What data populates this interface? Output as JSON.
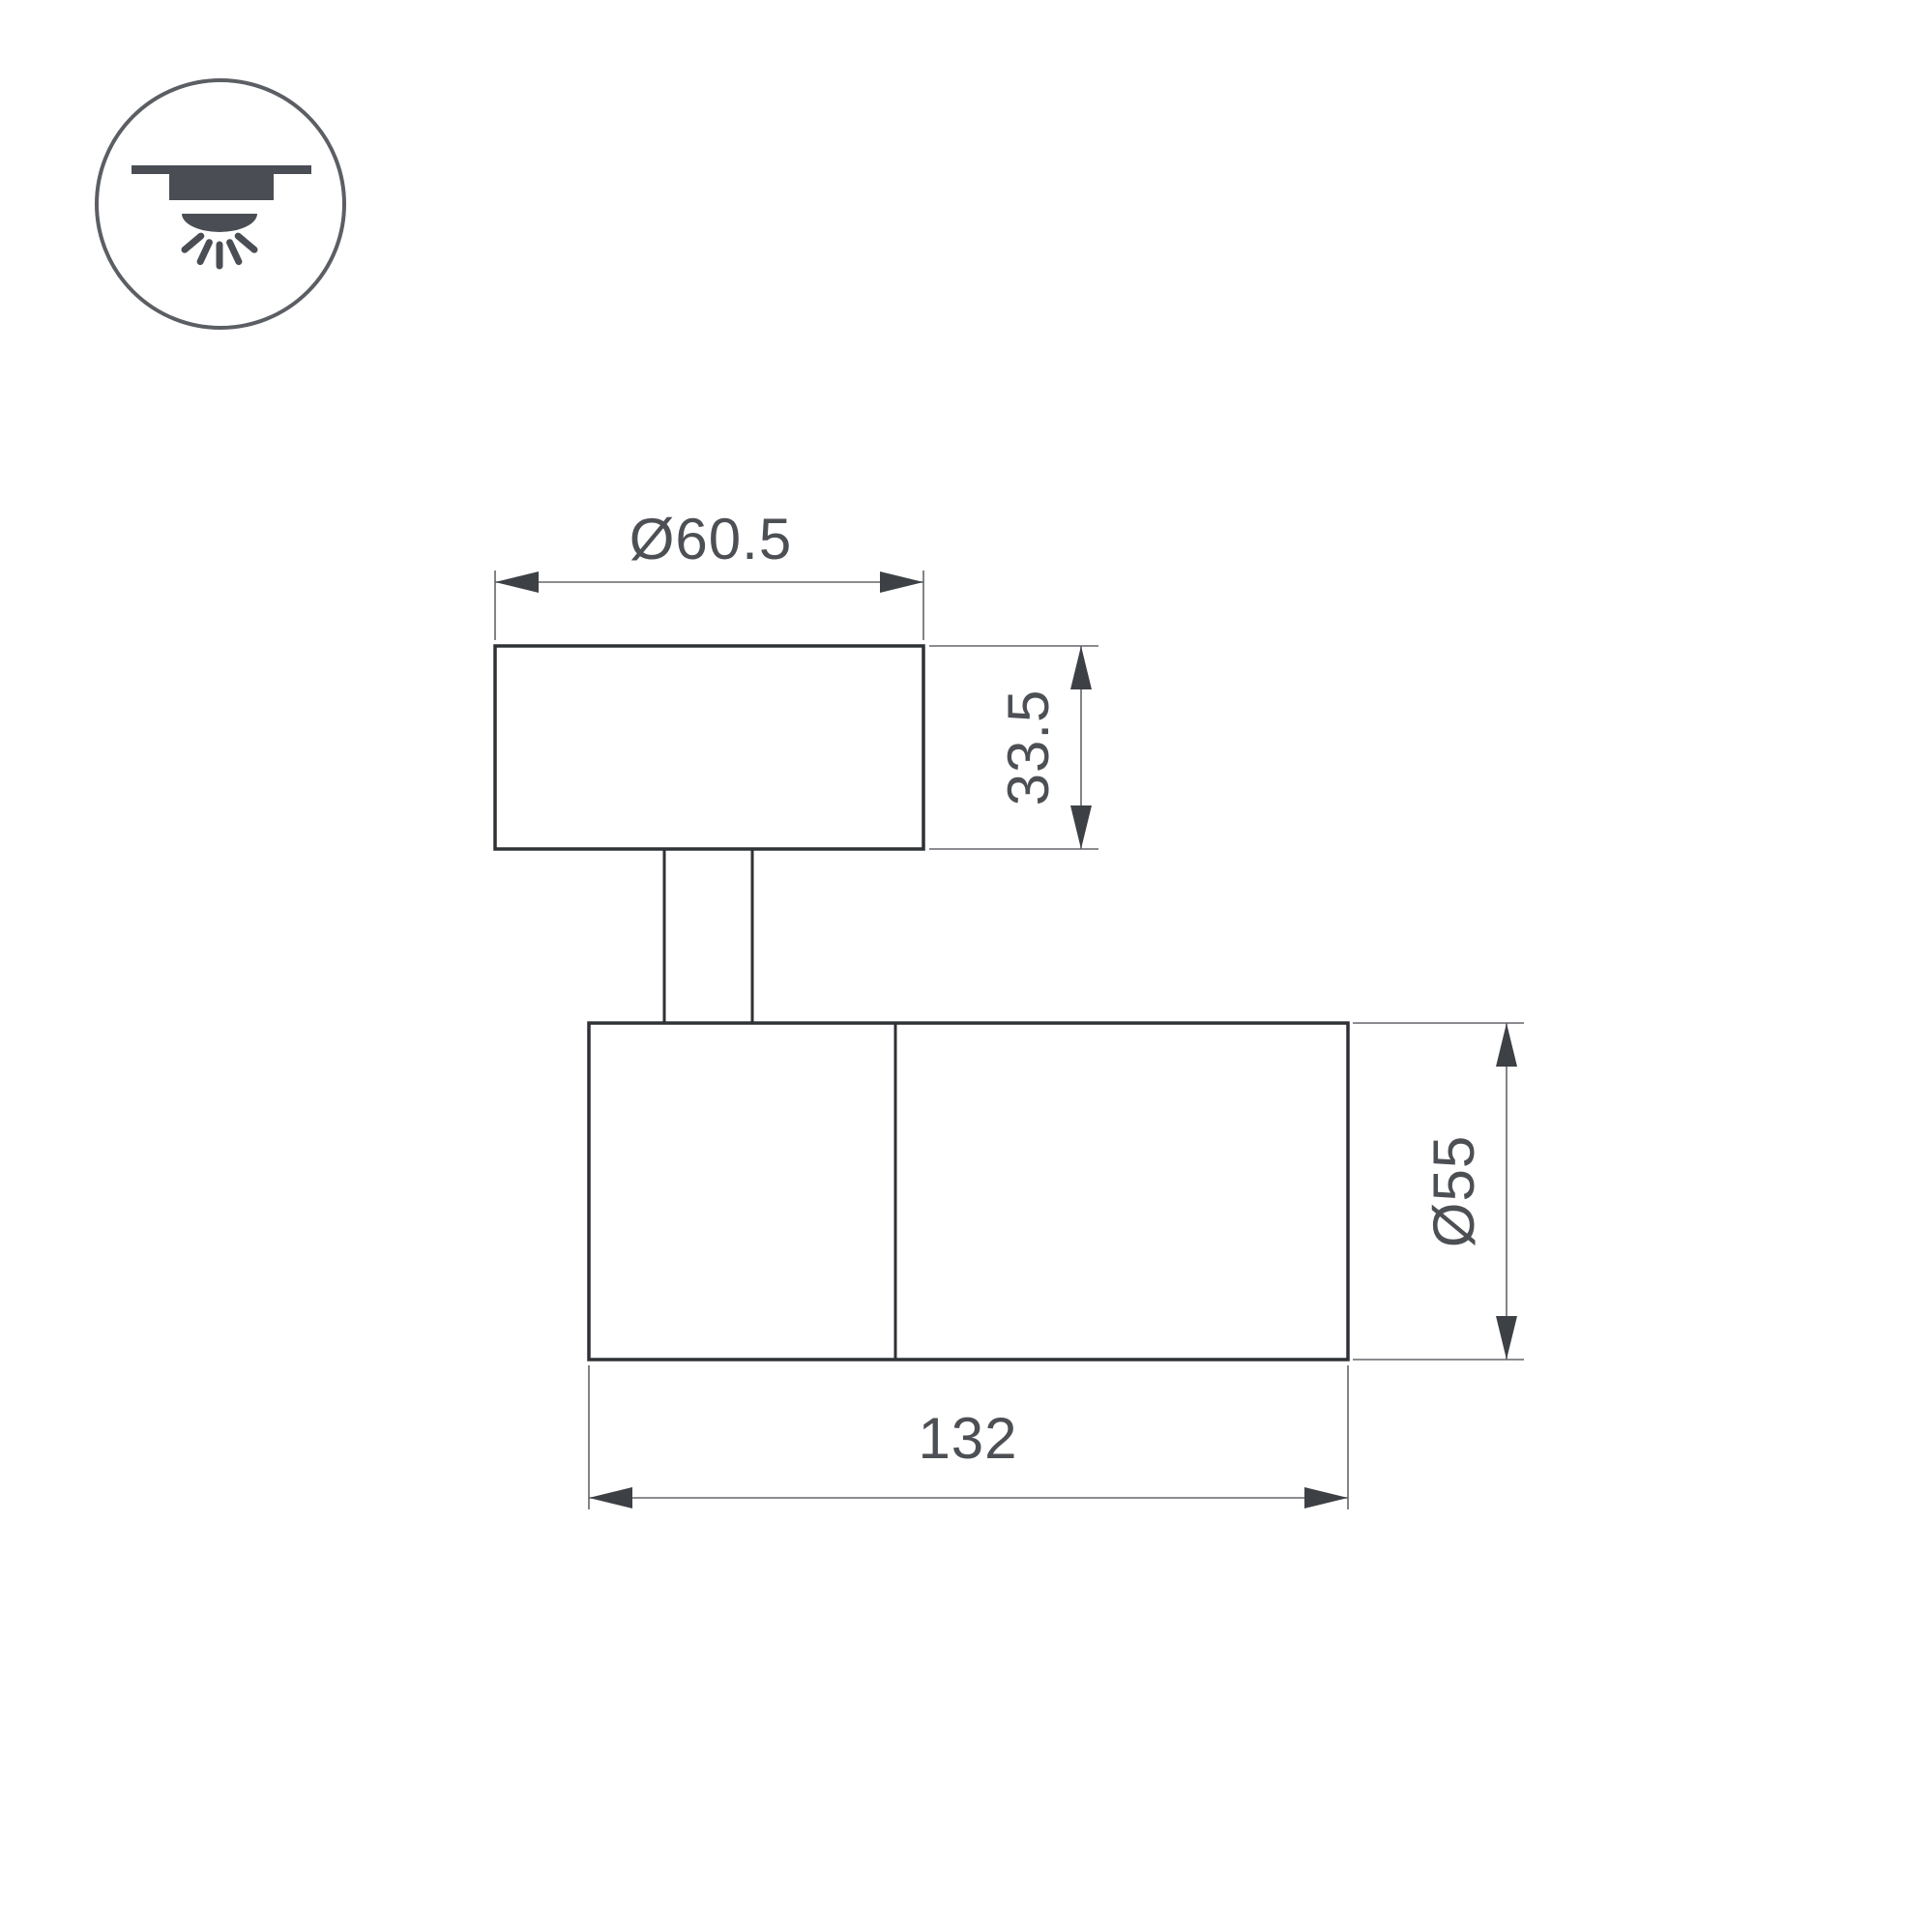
{
  "page": {
    "background_color": "#ffffff"
  },
  "mount_type_icon": {
    "meaning": "surface-mounted-downlight",
    "glyph_color": "#4a4e54",
    "ring_color": "#5b5e63"
  },
  "drawing": {
    "outline_color": "#2e3135",
    "dimension_line_color": "#63666a",
    "arrow_color": "#3d4045",
    "text_color": "#4c4f54",
    "dimensions": {
      "base_diameter": "Ø60.5",
      "base_height": "33.5",
      "body_diameter": "Ø55",
      "body_length": "132"
    }
  }
}
